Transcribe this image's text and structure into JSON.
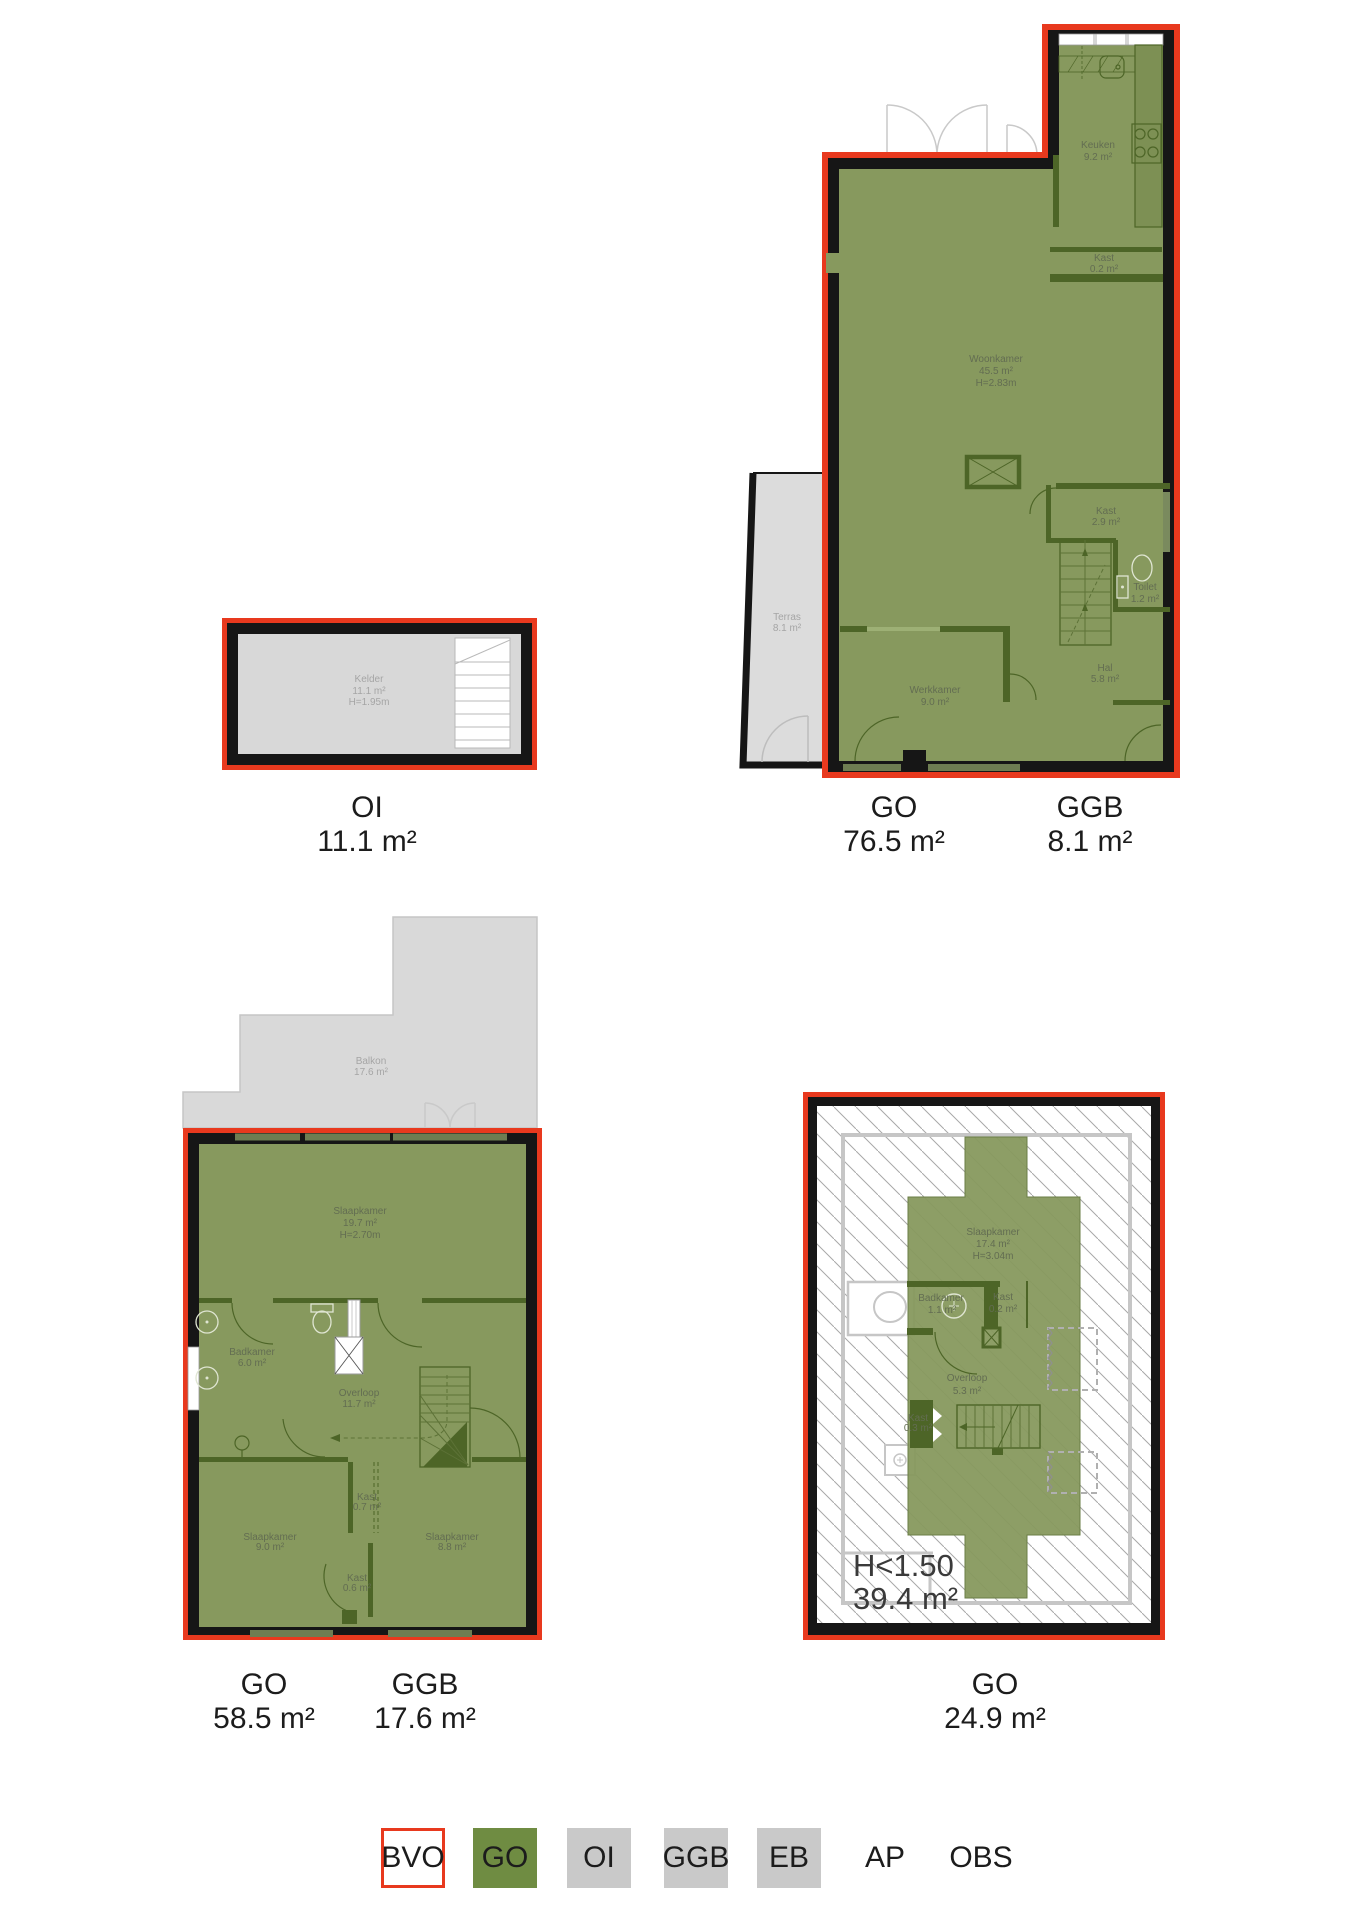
{
  "colors": {
    "outline_red": "#e8391e",
    "wall_black": "#161616",
    "go_green": "#87995e",
    "area_gray": "#d9d9d9",
    "legend_green": "#6f8c42",
    "legend_gray": "#c9c9c9"
  },
  "plans": {
    "kelder_plan": {
      "rooms": {
        "kelder": {
          "name": "Kelder",
          "area": "11.1 m²",
          "height": "H=1.95m"
        }
      },
      "totals": [
        {
          "code": "OI",
          "value": "11.1 m²"
        }
      ]
    },
    "begane_grond": {
      "rooms": {
        "keuken": {
          "name": "Keuken",
          "area": "9.2 m²"
        },
        "kast_keuken": {
          "name": "Kast",
          "area": "0.2 m²"
        },
        "woonkamer": {
          "name": "Woonkamer",
          "area": "45.5 m²",
          "height": "H=2.83m"
        },
        "kast": {
          "name": "Kast",
          "area": "2.9 m²"
        },
        "toilet": {
          "name": "Toilet",
          "area": "1.2 m²"
        },
        "hal": {
          "name": "Hal",
          "area": "5.8 m²"
        },
        "werkkamer": {
          "name": "Werkkamer",
          "area": "9.0 m²"
        },
        "terras": {
          "name": "Terras",
          "area": "8.1 m²"
        }
      },
      "totals": [
        {
          "code": "GO",
          "value": "76.5 m²"
        },
        {
          "code": "GGB",
          "value": "8.1 m²"
        }
      ]
    },
    "eerste_verdieping": {
      "rooms": {
        "balkon": {
          "name": "Balkon",
          "area": "17.6 m²"
        },
        "slaapkamer_groot": {
          "name": "Slaapkamer",
          "area": "19.7 m²",
          "height": "H=2.70m"
        },
        "badkamer": {
          "name": "Badkamer",
          "area": "6.0 m²"
        },
        "overloop": {
          "name": "Overloop",
          "area": "11.7 m²"
        },
        "slaapkamer_links": {
          "name": "Slaapkamer",
          "area": "9.0 m²"
        },
        "kast_boven": {
          "name": "Kast",
          "area": "0.7 m²"
        },
        "slaapkamer_rechts": {
          "name": "Slaapkamer",
          "area": "8.8 m²"
        },
        "kast_onder": {
          "name": "Kast",
          "area": "0.6 m²"
        }
      },
      "totals": [
        {
          "code": "GO",
          "value": "58.5 m²"
        },
        {
          "code": "GGB",
          "value": "17.6 m²"
        }
      ]
    },
    "zolder": {
      "rooms": {
        "slaapkamer": {
          "name": "Slaapkamer",
          "area": "17.4 m²",
          "height": "H=3.04m"
        },
        "badkamer": {
          "name": "Badkamer",
          "area": "1.1 m²"
        },
        "kast_klein": {
          "name": "Kast",
          "area": "0.2 m²"
        },
        "overloop": {
          "name": "Overloop",
          "area": "5.3 m²"
        },
        "kast": {
          "name": "Kast",
          "area": "0.3 m²"
        }
      },
      "annotation": {
        "line1": "H<1.50",
        "line2": "39.4 m²"
      },
      "totals": [
        {
          "code": "GO",
          "value": "24.9 m²"
        }
      ]
    }
  },
  "legend": {
    "items": [
      {
        "label": "BVO"
      },
      {
        "label": "GO"
      },
      {
        "label": "OI"
      },
      {
        "label": "GGB"
      },
      {
        "label": "EB"
      },
      {
        "label": "AP"
      },
      {
        "label": "OBS"
      }
    ]
  }
}
